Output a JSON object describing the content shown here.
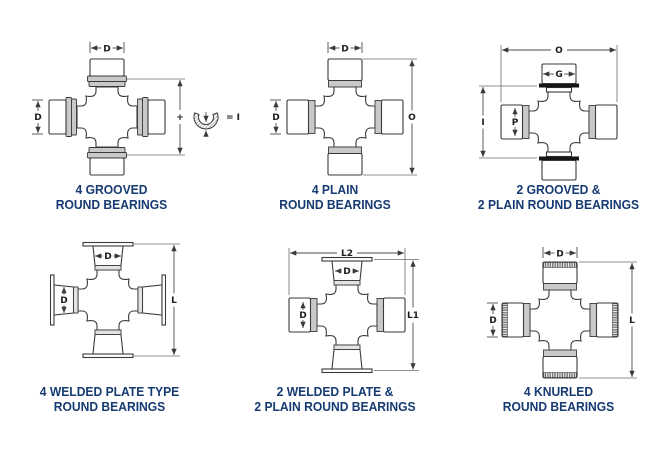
{
  "page": {
    "background": "#ffffff"
  },
  "colors": {
    "caption_navy": "#163a72",
    "outline": "#3a3a3a",
    "groove_band_gray": "#c9c9c9",
    "snap_ring_black": "#151515",
    "dimension_line": "#4d4d4d"
  },
  "diagrams": [
    {
      "id": "four-grooved",
      "caption": [
        "4 GROOVED",
        "ROUND BEARINGS"
      ],
      "labels": {
        "d_top": "D",
        "d_left": "D",
        "plus": "+",
        "equals_i": "= I"
      }
    },
    {
      "id": "four-plain",
      "caption": [
        "4 PLAIN",
        "ROUND BEARINGS"
      ],
      "labels": {
        "d_top": "D",
        "d_left": "D",
        "o_right": "O"
      }
    },
    {
      "id": "two-grooved-two-plain",
      "caption": [
        "2 GROOVED &",
        "2 PLAIN ROUND BEARINGS"
      ],
      "labels": {
        "o_top": "O",
        "g_top": "G",
        "i_left": "I",
        "p_left": "P"
      }
    },
    {
      "id": "four-welded-plate",
      "caption": [
        "4 WELDED PLATE TYPE",
        "ROUND BEARINGS"
      ],
      "labels": {
        "d_top": "D",
        "d_left": "D",
        "l_right": "L"
      }
    },
    {
      "id": "two-welded-two-plain",
      "caption": [
        "2 WELDED PLATE &",
        "2 PLAIN ROUND BEARINGS"
      ],
      "labels": {
        "l2_top": "L2",
        "d_top": "D",
        "d_left": "D",
        "l1_right": "L1"
      }
    },
    {
      "id": "four-knurled",
      "caption": [
        "4 KNURLED",
        "ROUND BEARINGS"
      ],
      "labels": {
        "d_top": "D",
        "d_left": "D",
        "l_right": "L"
      }
    }
  ]
}
